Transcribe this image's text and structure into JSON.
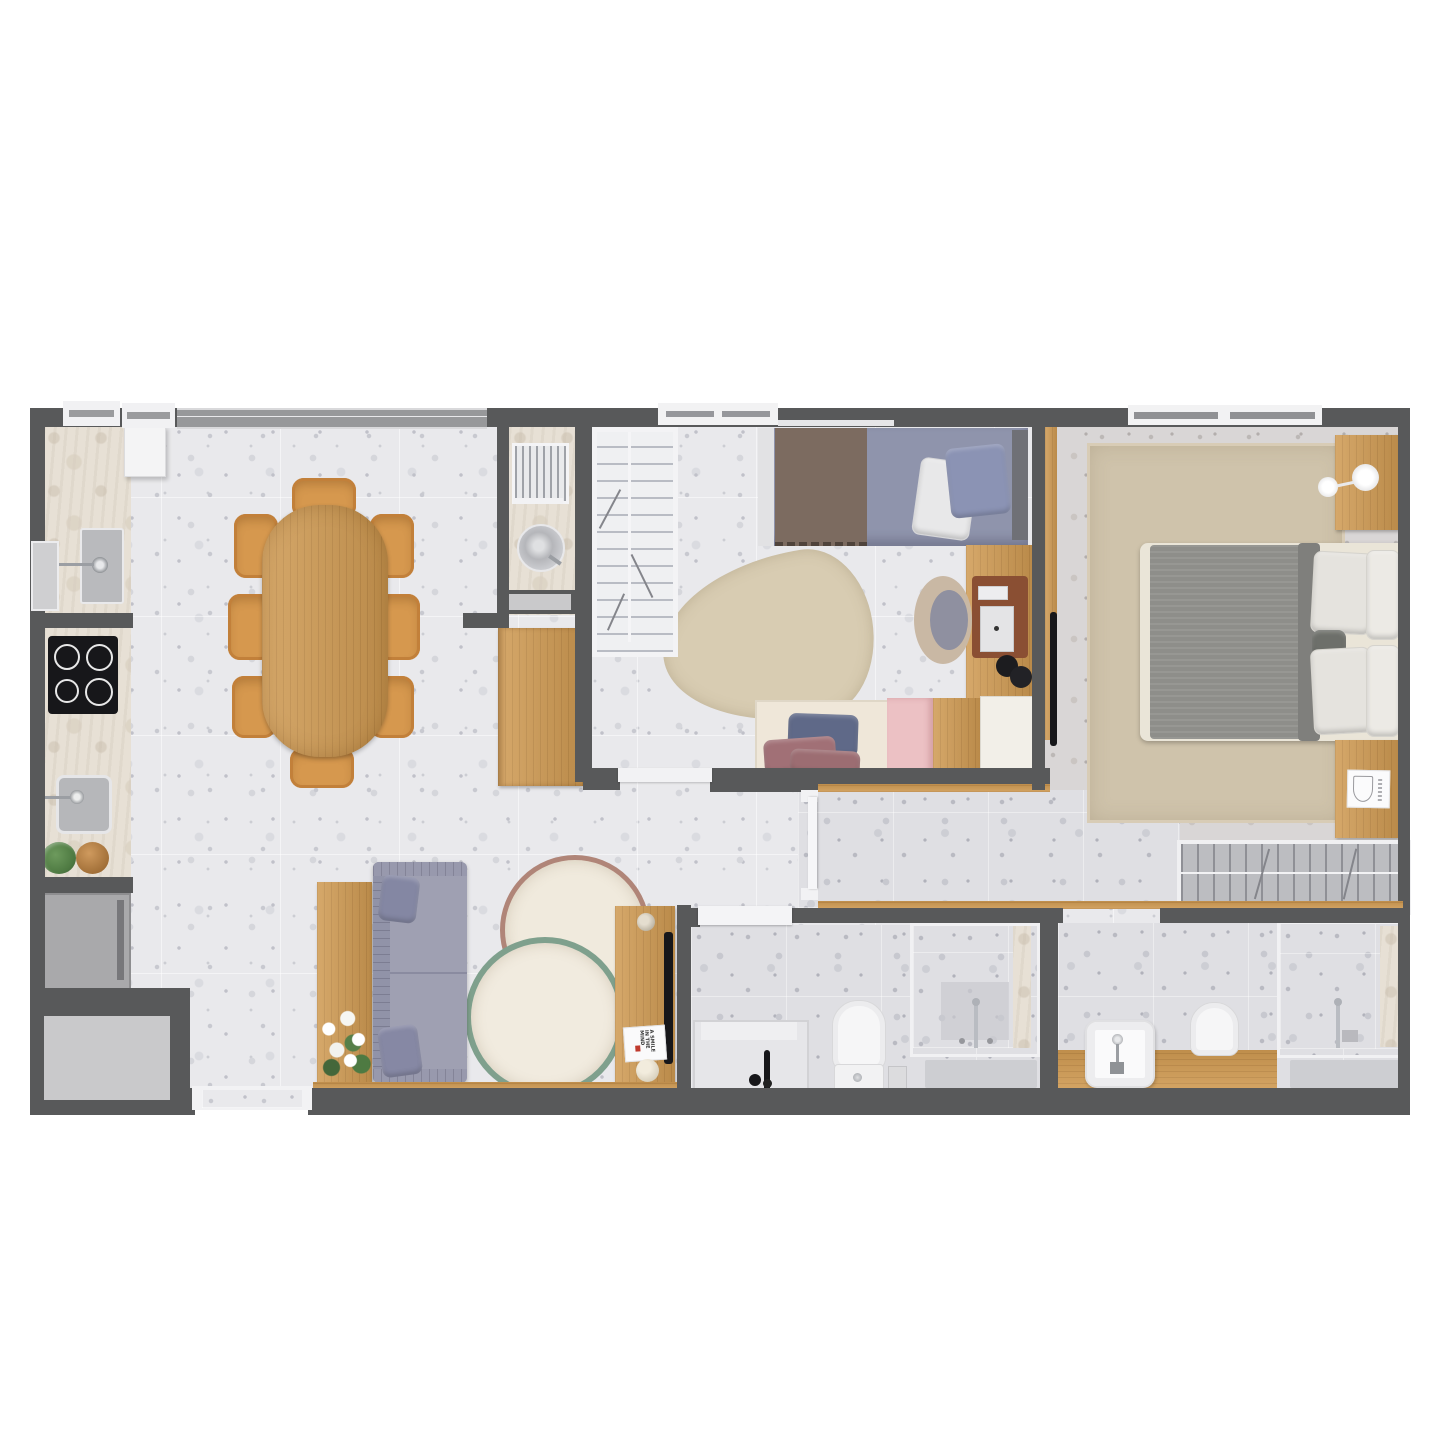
{
  "meta": {
    "type": "apartment-floor-plan",
    "view": "top-down-render",
    "background": "#ffffff"
  },
  "palette": {
    "wall": "#58595a",
    "floor": "#e9e9ec",
    "floorDark": "#dfdfe3",
    "floorWarm": "#d9d6d6",
    "stone": "#e7e0d5",
    "wood": "#cf9a52",
    "woodEdge": "#b97f3e",
    "white": "#f4f4f5",
    "applianceGray": "#a9a9ab",
    "panelGray": "#c9c9cb",
    "black": "#17171a",
    "chrome": "#b9bcc2",
    "sofaGray": "#9fa0b2",
    "pillowGray": "#8487a3",
    "duvetBlue": "#8f94ac",
    "throwBrown": "#7c6b60",
    "headboardGray": "#6f7076",
    "bedCream": "#eae5d8",
    "blanketGray": "#8e8e8a",
    "rugBeige": "#cfc3ab",
    "rugCream": "#f0eadd",
    "ringRose": "#b08578",
    "ringSage": "#7fa08d",
    "leafRug": "#d8ccb2",
    "pinkBox": "#ecc1c4",
    "creamBench": "#efe7d9",
    "navyPillow": "#5f6988",
    "mauvePillow": "#a17076",
    "chairBeige": "#c9b8a4",
    "matBrown": "#8a4f33",
    "plantGreen": "#4e7a42"
  },
  "rooms": {
    "list": [
      "kitchen-dining",
      "laundry-nook",
      "kids-bedroom",
      "kids-closet",
      "master-bedroom",
      "hallway",
      "bathroom-1",
      "bathroom-2",
      "living-room",
      "entry"
    ]
  },
  "living_room": {
    "book_title": "A SMILE IN THE MIND"
  },
  "furniture": {
    "kitchen": [
      "tall-cabinet",
      "counter-sink",
      "counter-cooktop",
      "cooktop-4-burners",
      "laundry-sink-square",
      "plant-pot",
      "wood-bowl",
      "refrigerator"
    ],
    "dining": [
      "oval-table",
      "chairs-x8"
    ],
    "laundry": [
      "drying-rack",
      "round-wash-tub",
      "pocket-door",
      "sideboard-cabinet"
    ],
    "kids_bedroom": [
      "single-bed",
      "leaf-rug",
      "desk",
      "desk-chair",
      "tablet",
      "headphones",
      "bench-with-pillows",
      "pink-chest",
      "wood-chest",
      "white-chest",
      "closet-shelving"
    ],
    "master_bedroom": [
      "double-bed",
      "area-rug",
      "nightstand-top",
      "nightstand-bottom",
      "wall-lamp",
      "wall-tv",
      "wardrobe-hanging-rail",
      "print-card"
    ],
    "living": [
      "sofa",
      "console-table",
      "flower-bouquet",
      "round-rug-rose",
      "round-rug-sage",
      "tv-sideboard",
      "speaker",
      "tv",
      "book",
      "decor-ball"
    ],
    "bathroom_1": [
      "bathtub",
      "black-tub-faucet",
      "toilet",
      "paper-holder",
      "glass-shower",
      "shower-column",
      "bath-mat"
    ],
    "bathroom_2": [
      "wood-vanity",
      "vessel-sink",
      "toilet",
      "glass-shower",
      "shower-column",
      "bath-mat"
    ]
  },
  "openings": {
    "windows": [
      "kitchen-window-a",
      "kitchen-window-b",
      "left-wall-window",
      "dining-window",
      "kids-window",
      "master-window"
    ],
    "doors": [
      "entry-door",
      "kids-room-door",
      "hall-door",
      "bathroom-1-door",
      "laundry-pocket-door"
    ]
  }
}
